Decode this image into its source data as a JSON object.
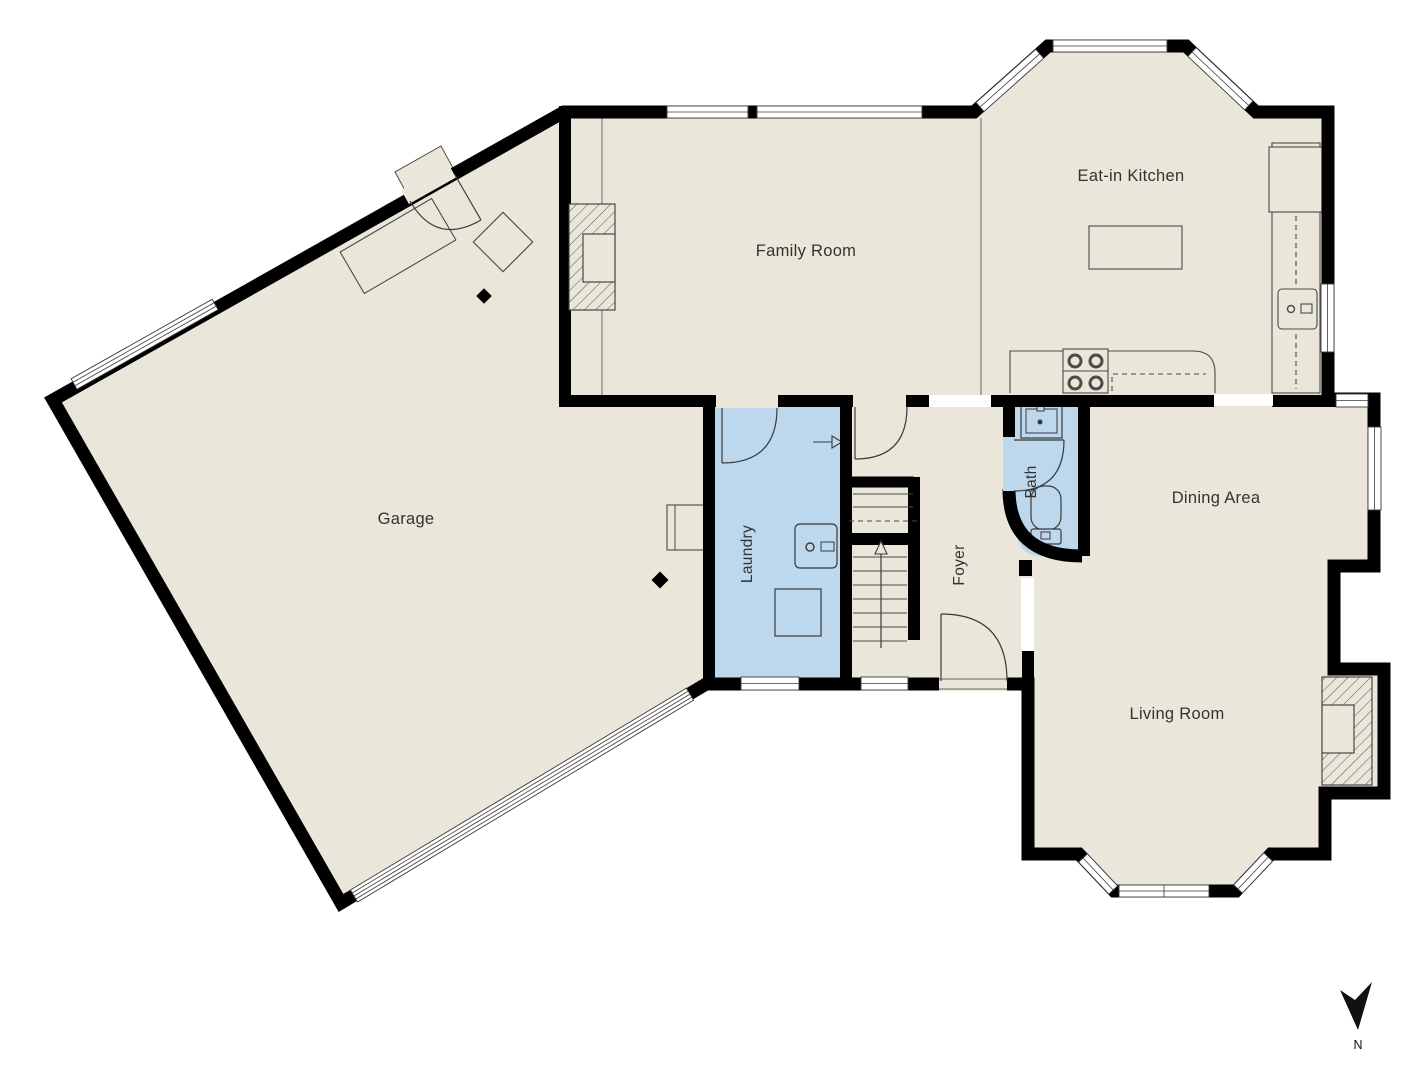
{
  "title": "First floor plan",
  "colors": {
    "background": "#FFFFFF",
    "floor": "#EAE6D9",
    "room_highlight": "#BDD7EC",
    "wall": "#000000",
    "text": "#333333",
    "north_arrow": "#111111"
  },
  "rooms": {
    "eat_in_kitchen": {
      "label": "Eat-in Kitchen"
    },
    "family_room": {
      "label": "Family Room"
    },
    "garage": {
      "label": "Garage"
    },
    "laundry": {
      "label": "Laundry"
    },
    "foyer": {
      "label": "Foyer"
    },
    "bath": {
      "label": "Bath"
    },
    "dining_area": {
      "label": "Dining Area"
    },
    "living_room": {
      "label": "Living Room"
    }
  },
  "compass": {
    "north_label": "N"
  }
}
